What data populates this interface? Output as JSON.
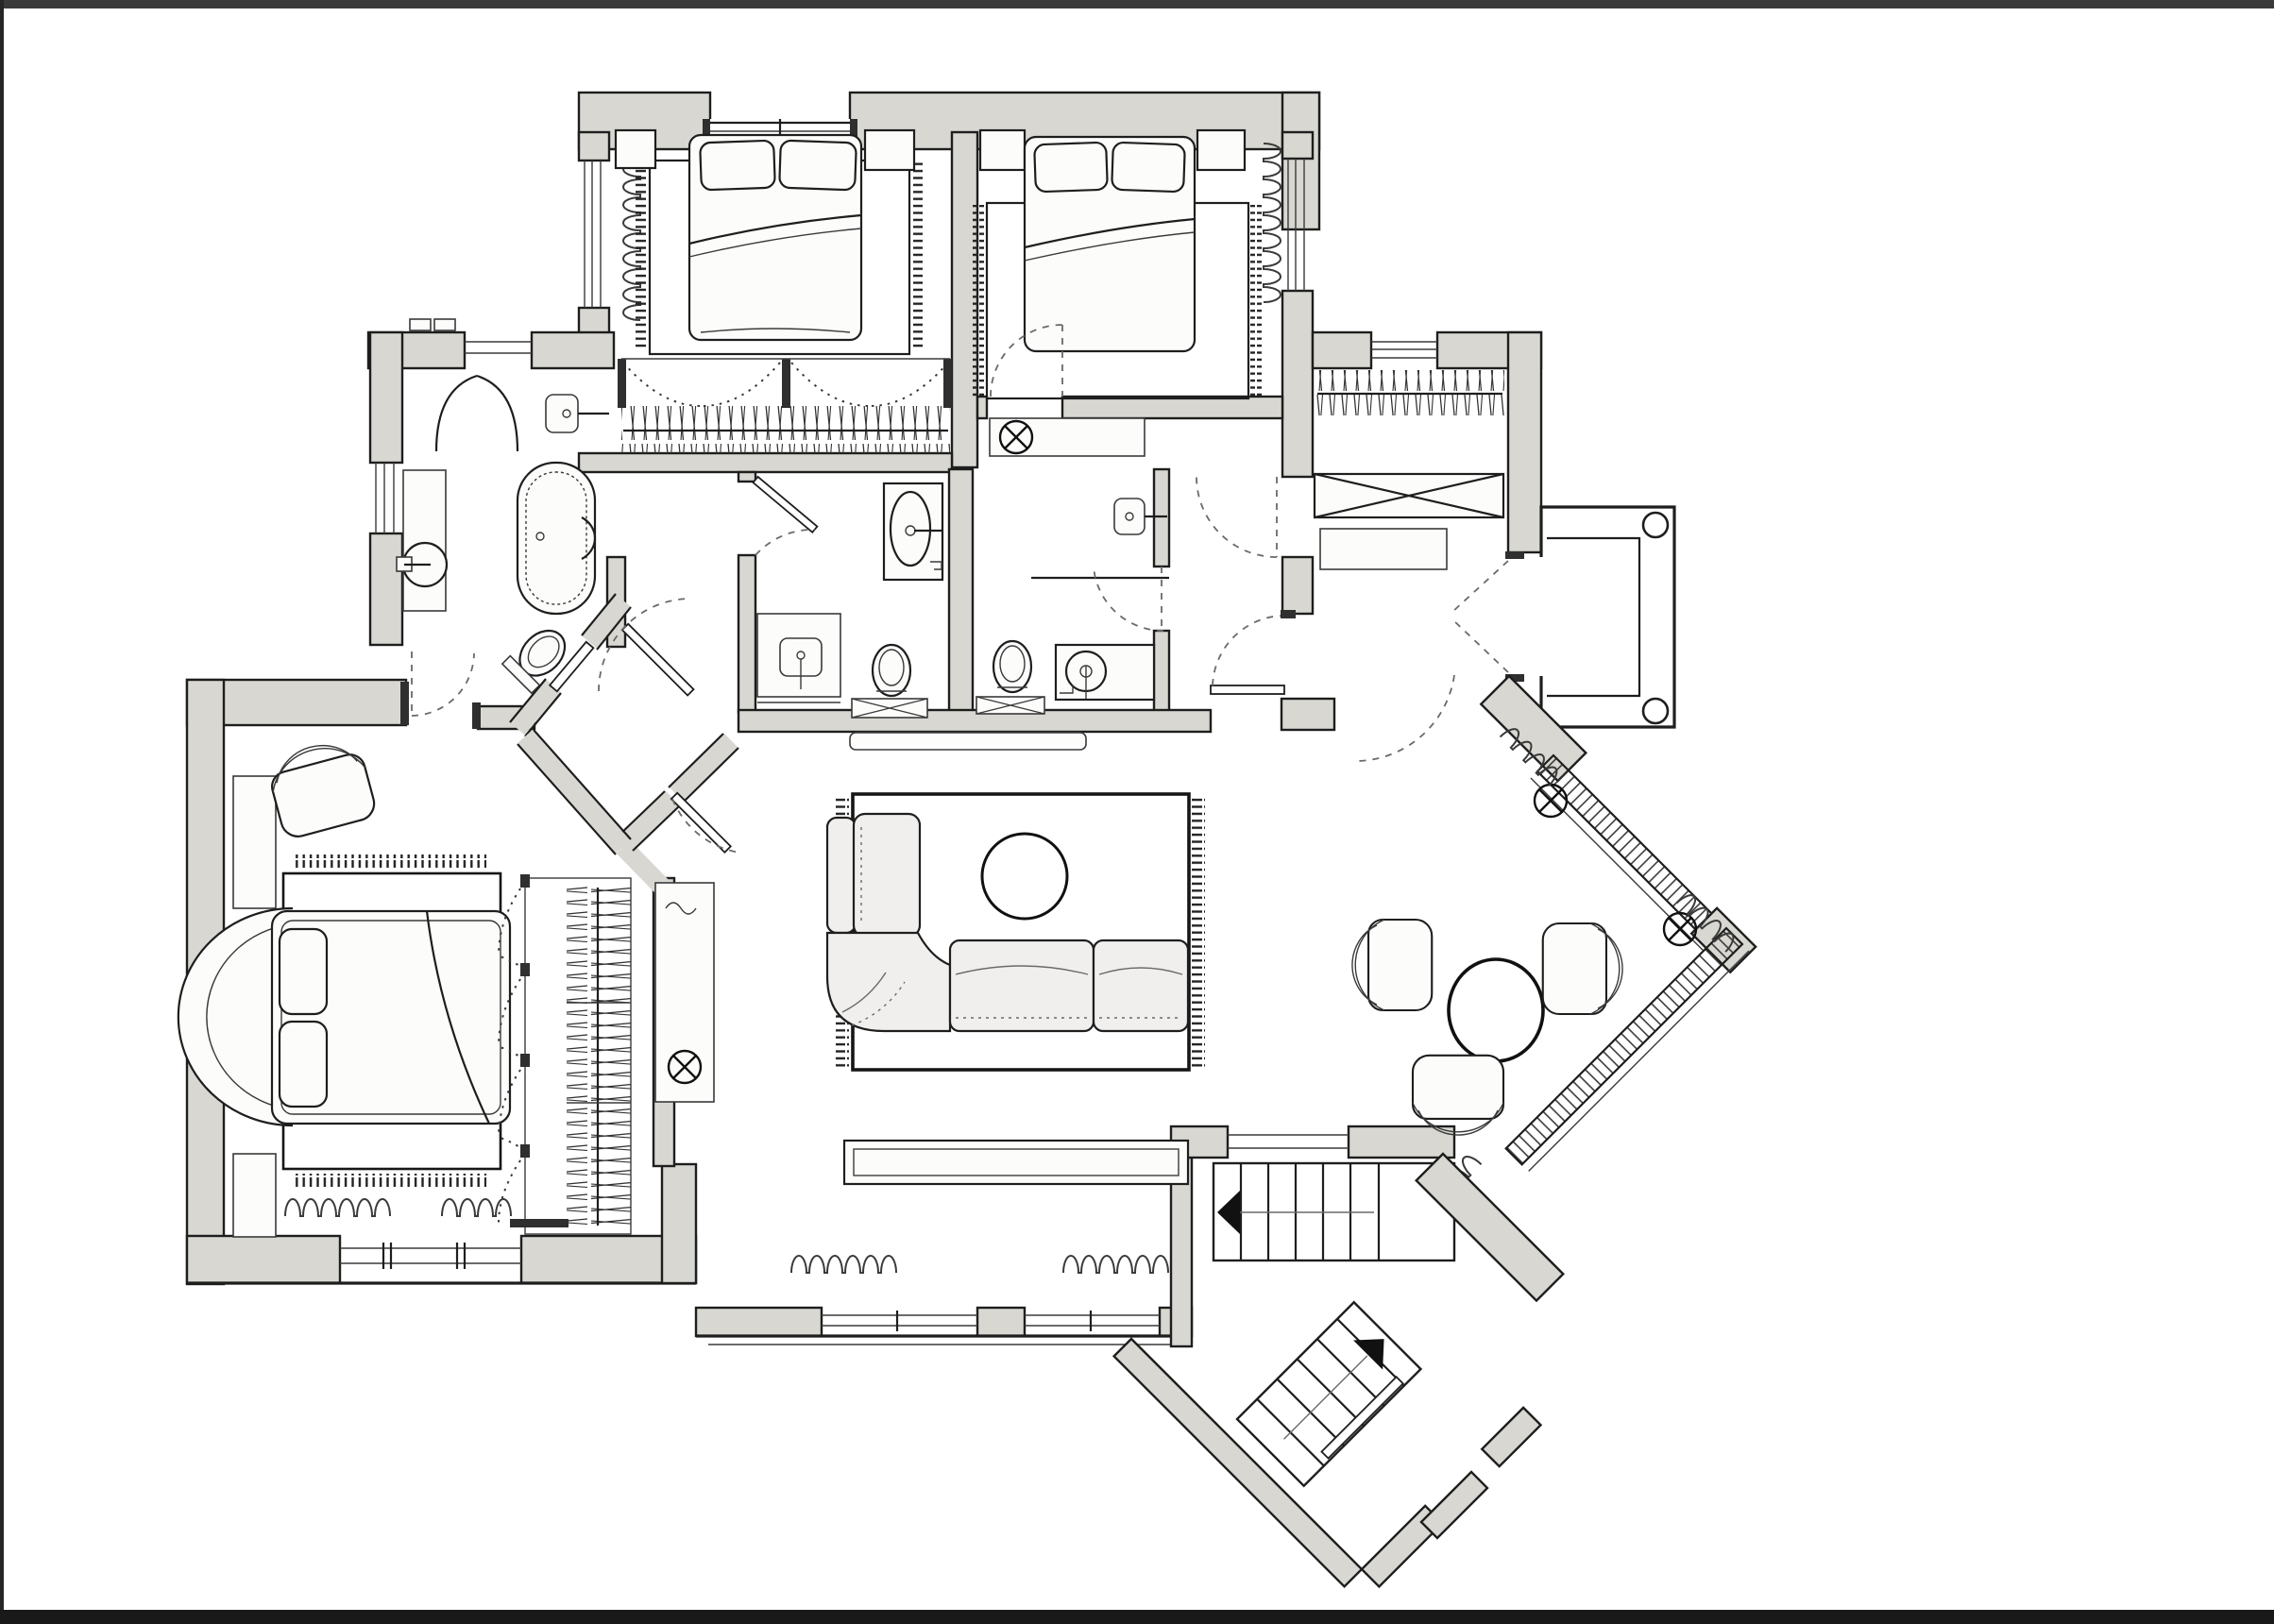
{
  "meta": {
    "title": "Apartment floor plan drawing",
    "kind": "architectural-plan",
    "text_labels": []
  },
  "palette": {
    "canvas": "#ffffff",
    "frame_top": "#3a3a3a",
    "frame_side": "#262626",
    "frame_bottom": "#191919",
    "wall_fill": "#d8d7d1",
    "wall_line": "#1e1e1e",
    "thin_line": "#3a3a3a",
    "soft_line": "#6a6a6a",
    "furniture_fill": "#fcfcfb",
    "sofa_fill": "#f0efed",
    "symbol_line": "#111111"
  },
  "rooms": [
    {
      "id": "bedroom-1",
      "furniture": [
        "double-bed",
        "pillow",
        "pillow",
        "nightstand-left",
        "nightstand-right",
        "area-rug-fringed",
        "radiator",
        "bifold-wardrobe-with-hangers",
        "window-top",
        "window-left"
      ]
    },
    {
      "id": "bedroom-2",
      "furniture": [
        "double-bed",
        "pillow",
        "pillow",
        "nightstand-left",
        "nightstand-right",
        "area-rug-fringed",
        "radiator",
        "window-right",
        "door-dashed"
      ]
    },
    {
      "id": "bathroom-1",
      "furniture": [
        "freestanding-oval-bathtub",
        "round-washbasin-on-counter",
        "toilet-angled",
        "pointed-door-arc",
        "window-left",
        "wall-lamp"
      ]
    },
    {
      "id": "shower-room",
      "furniture": [
        "washbasin-cabinet",
        "vanity-counter",
        "toilet",
        "crossed-mat",
        "door-arc"
      ]
    },
    {
      "id": "bathroom-2",
      "furniture": [
        "toilet",
        "crossed-mat",
        "round-washbasin-counter",
        "wall-lamp",
        "door-dashed"
      ]
    },
    {
      "id": "corridor",
      "furniture": [
        "ceiling-light-niche"
      ]
    },
    {
      "id": "wardrobe-hall",
      "furniture": [
        "hanger-rail",
        "crossed-wardrobe-box",
        "shelf",
        "window-top",
        "door-dashed"
      ]
    },
    {
      "id": "terrace",
      "furniture": [
        "round-column",
        "round-column",
        "french-double-door"
      ]
    },
    {
      "id": "living-room",
      "furniture": [
        "sectional-sofa",
        "round-coffee-table",
        "large-fringed-rug",
        "window-bench",
        "wall-console",
        "side-table-with-lamp",
        "radiator",
        "radiator",
        "window",
        "window",
        "hall-door"
      ]
    },
    {
      "id": "master-bedroom",
      "furniture": [
        "bed-with-curved-headboard",
        "pillow",
        "pillow",
        "armchair",
        "wall-shelf",
        "wall-shelf",
        "fringed-rug",
        "bifold-wardrobe-with-hangers",
        "radiator",
        "radiator",
        "triple-window",
        "entry-door-dashed"
      ]
    },
    {
      "id": "dining-nook",
      "furniture": [
        "oval-table",
        "armchair",
        "armchair",
        "armchair"
      ]
    },
    {
      "id": "glazed-bay",
      "furniture": [
        "glazing-hatched",
        "ceiling-light",
        "ceiling-light",
        "radiator",
        "radiator"
      ]
    },
    {
      "id": "entry-stairs",
      "furniture": [
        "upper-stair-flight",
        "diagonal-stair-flight",
        "direction-arrow",
        "direction-arrow",
        "landing",
        "entry-door-leaf",
        "glazed-partition"
      ]
    },
    {
      "id": "vestibule",
      "furniture": [
        "angled-door",
        "angled-door",
        "angled-door",
        "door-to-master"
      ]
    }
  ],
  "symbols": {
    "ceiling_lights": 4,
    "radiators": 9,
    "columns": 2,
    "stair_arrows": 2
  }
}
